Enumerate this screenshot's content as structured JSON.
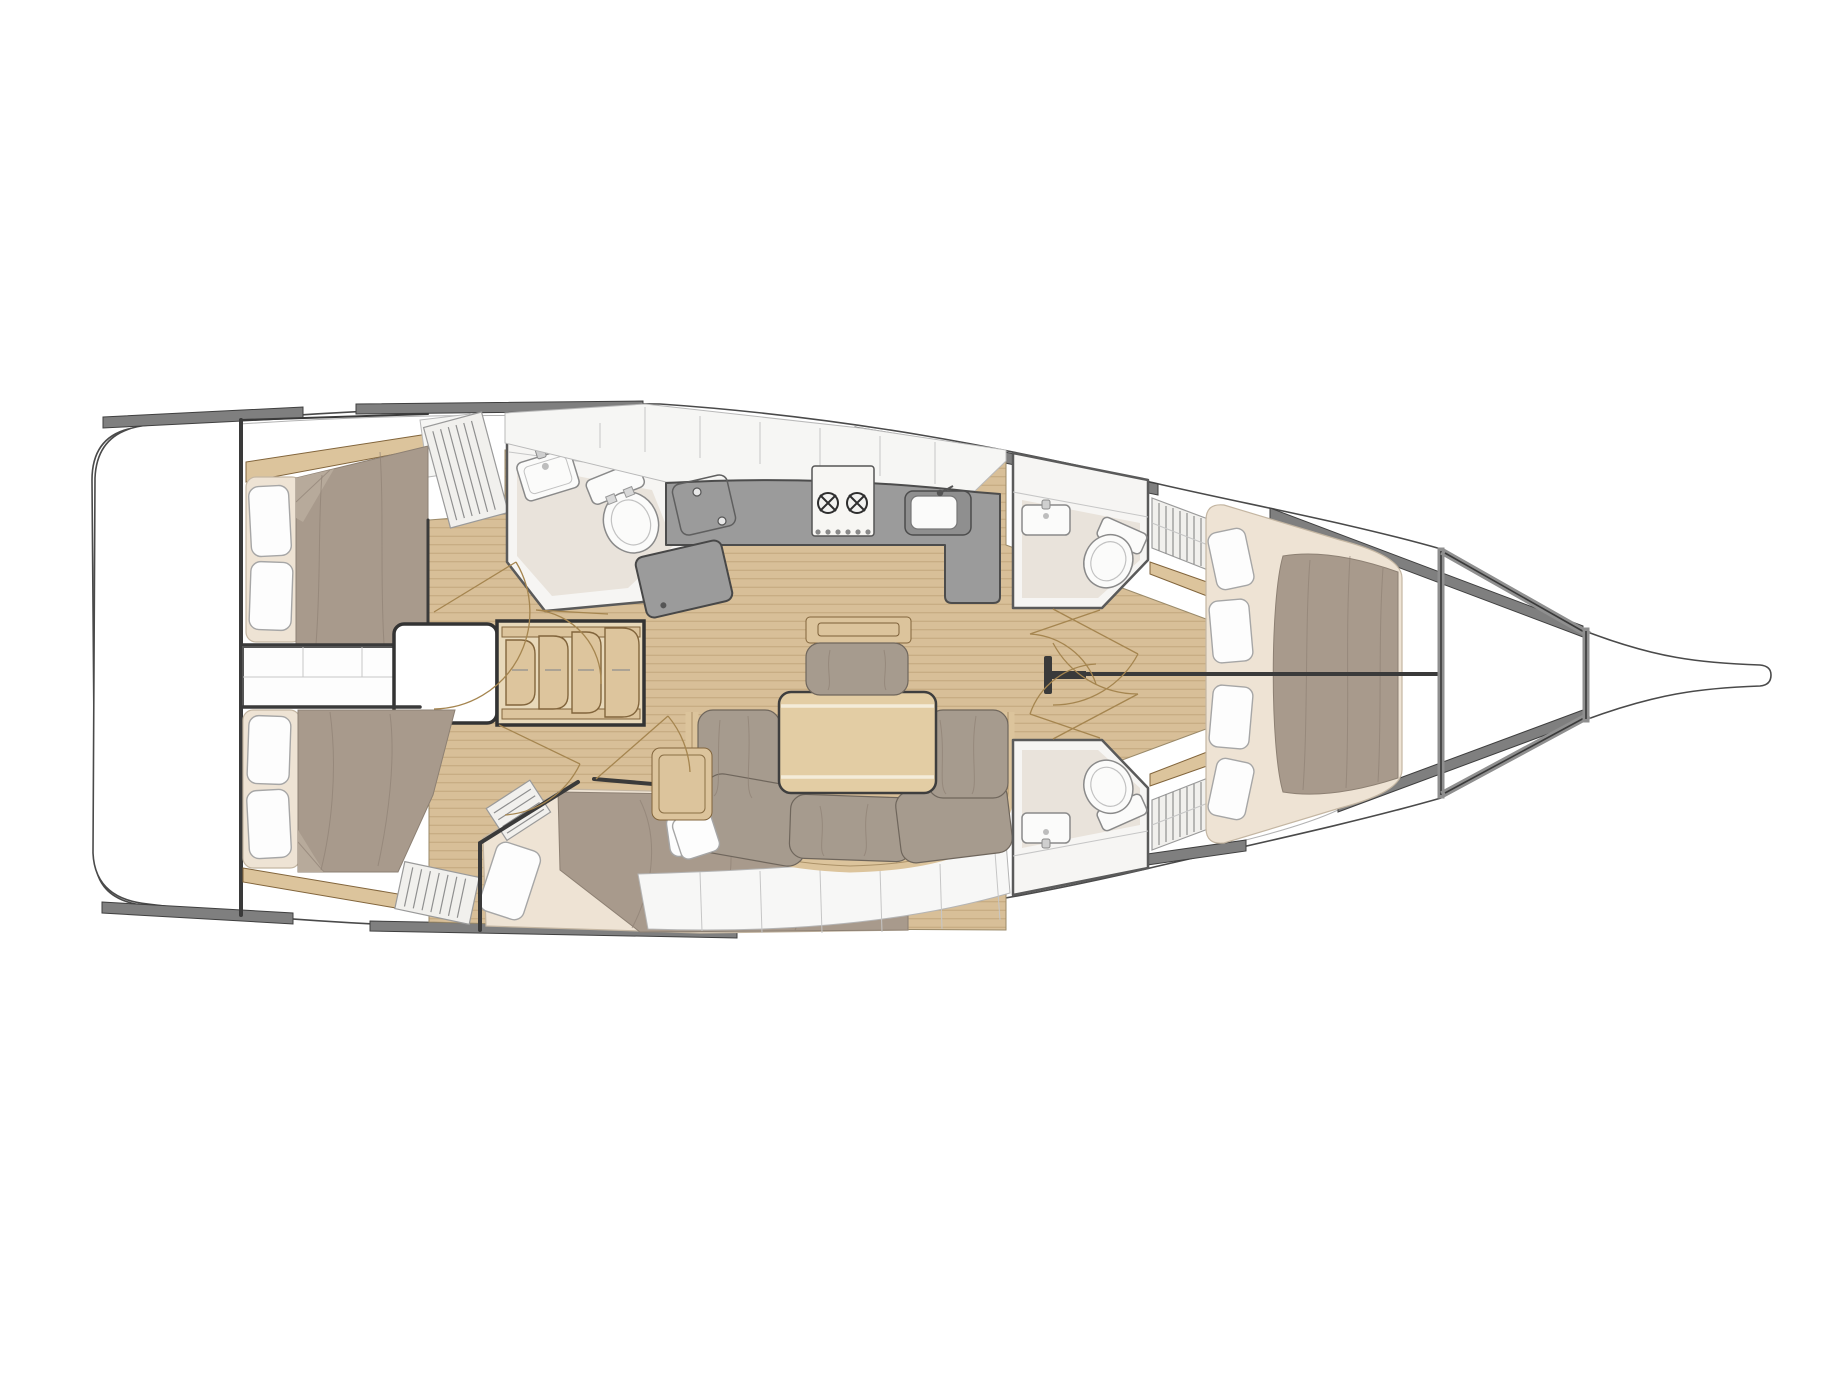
{
  "diagram": {
    "kind": "sailing-yacht-interior-floorplan-top-view",
    "orientation": {
      "bow": "right",
      "stern": "left"
    },
    "rooms": [
      {
        "id": "transom",
        "name": "stern swim platform",
        "furniture": []
      },
      {
        "id": "aft-cabin-port",
        "name": "aft cabin (upper left)",
        "furniture": [
          "double berth",
          "2 pillows",
          "hull shelf",
          "corner cabinet",
          "louvered wardrobe"
        ]
      },
      {
        "id": "aft-cabin-starboard",
        "name": "aft cabin (lower left)",
        "furniture": [
          "double berth",
          "2 pillows",
          "wood rim",
          "louvered wardrobe"
        ]
      },
      {
        "id": "midship-storage",
        "name": "storage lockers between aft cabins",
        "furniture": [
          "segmented lockers"
        ]
      },
      {
        "id": "companionway",
        "name": "companionway",
        "furniture": [
          "landing platform",
          "4 curved wooden steps"
        ]
      },
      {
        "id": "aft-head",
        "name": "aft head (bathroom)",
        "furniture": [
          "corner sink",
          "marine toilet"
        ]
      },
      {
        "id": "galley",
        "name": "L-shaped galley",
        "furniture": [
          "two-burner stove",
          "sink",
          "top-loading fridge",
          "chart table",
          "overhead lockers"
        ]
      },
      {
        "id": "salon",
        "name": "salon",
        "furniture": [
          "U-shaped settee",
          "folding dining table",
          "bench seat with wooden rail",
          "side cabinet",
          "throw pillow",
          "mast foot"
        ]
      },
      {
        "id": "guest-cabin",
        "name": "diagonal guest cabin (lower center)",
        "furniture": [
          "double berth",
          "2 pillows",
          "louvered panel"
        ]
      },
      {
        "id": "fwd-head-port",
        "name": "forward head port",
        "furniture": [
          "sink",
          "marine toilet",
          "louvered hanging locker"
        ]
      },
      {
        "id": "fwd-head-starboard",
        "name": "forward head starboard",
        "furniture": [
          "sink",
          "marine toilet",
          "louvered hanging locker"
        ]
      },
      {
        "id": "forward-cabins",
        "name": "twin forward cabins with split V-berth",
        "furniture": [
          "V-berth split by centerline partition",
          "4 pillows"
        ]
      },
      {
        "id": "forepeak",
        "name": "forepeak / anchor locker",
        "furniture": []
      }
    ],
    "doors_with_swing_arcs": 8,
    "heads_count": 3,
    "cabins_count": 5
  },
  "colors": {
    "page_bg": "#ffffff",
    "hull_line": "#4a4a4a",
    "bulwark": "#7f7f7f",
    "bulwark_edge": "#3f3f3f",
    "wall_dark": "#3a3a3a",
    "wall_mid": "#8f8f8f",
    "teak": "#d8bf98",
    "plank": "#a5895c",
    "wood": "#dcc49c",
    "wood_dark": "#82653c",
    "step": "#ddc59d",
    "bed": "#a89a8c",
    "bed_fold": "#b7aa9b",
    "bed_seam": "#8d8073",
    "sheet": "#eee3d4",
    "pillow": "#fdfdfd",
    "pillow_edge": "#a6a6a6",
    "cushion": "#a69b8e",
    "cushion_edge": "#6f665c",
    "counter": "#9b9b9b",
    "counter_edge": "#4c4c4c",
    "fixture": "#fbfbfa",
    "fixture_edge": "#8a8a8a",
    "head_floor": "#e9e3db",
    "room_white": "#f6f5f3",
    "room_edge": "#5a5a5a",
    "shelf": "#f7f7f6",
    "seam": "#c6c6c6",
    "louver": "#f1f0ed",
    "louver_line": "#8f8f8f",
    "arc": "#a5854f",
    "table": "#e3cda4"
  }
}
